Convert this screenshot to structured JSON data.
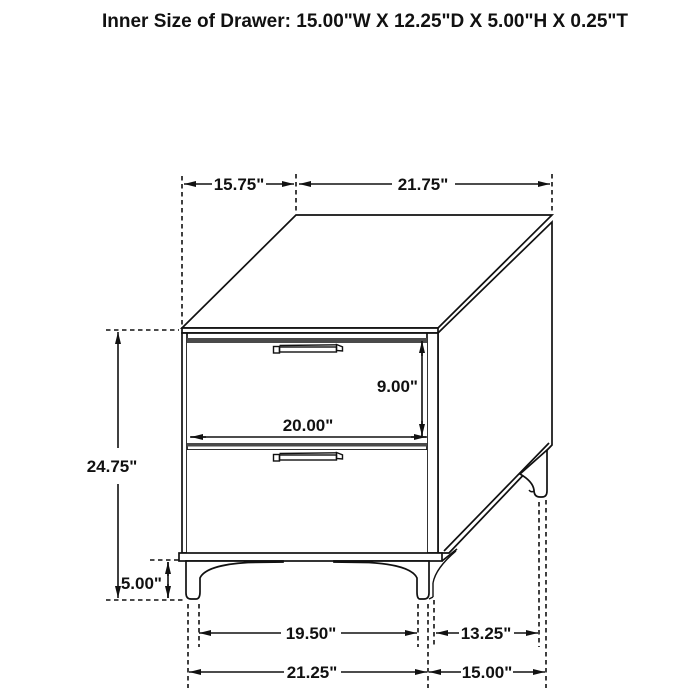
{
  "title": "Inner Size of Drawer: 15.00\"W X 12.25\"D X 5.00\"H X 0.25\"T",
  "diagram": {
    "type": "furniture-dimension-drawing",
    "subject": "two-drawer nightstand, isometric view",
    "labels": {
      "top_depth": "15.75\"",
      "top_width": "21.75\"",
      "drawer_front_height": "9.00\"",
      "drawer_front_width": "20.00\"",
      "overall_height": "24.75\"",
      "leg_height": "5.00\"",
      "front_legs_inner_span": "19.50\"",
      "side_legs_inner_span": "13.25\"",
      "front_legs_outer_span": "21.25\"",
      "side_legs_outer_span": "15.00\""
    }
  },
  "colors": {
    "background": "#ffffff",
    "line": "#111111",
    "dark_rail_strip": "#4a4a4a"
  }
}
